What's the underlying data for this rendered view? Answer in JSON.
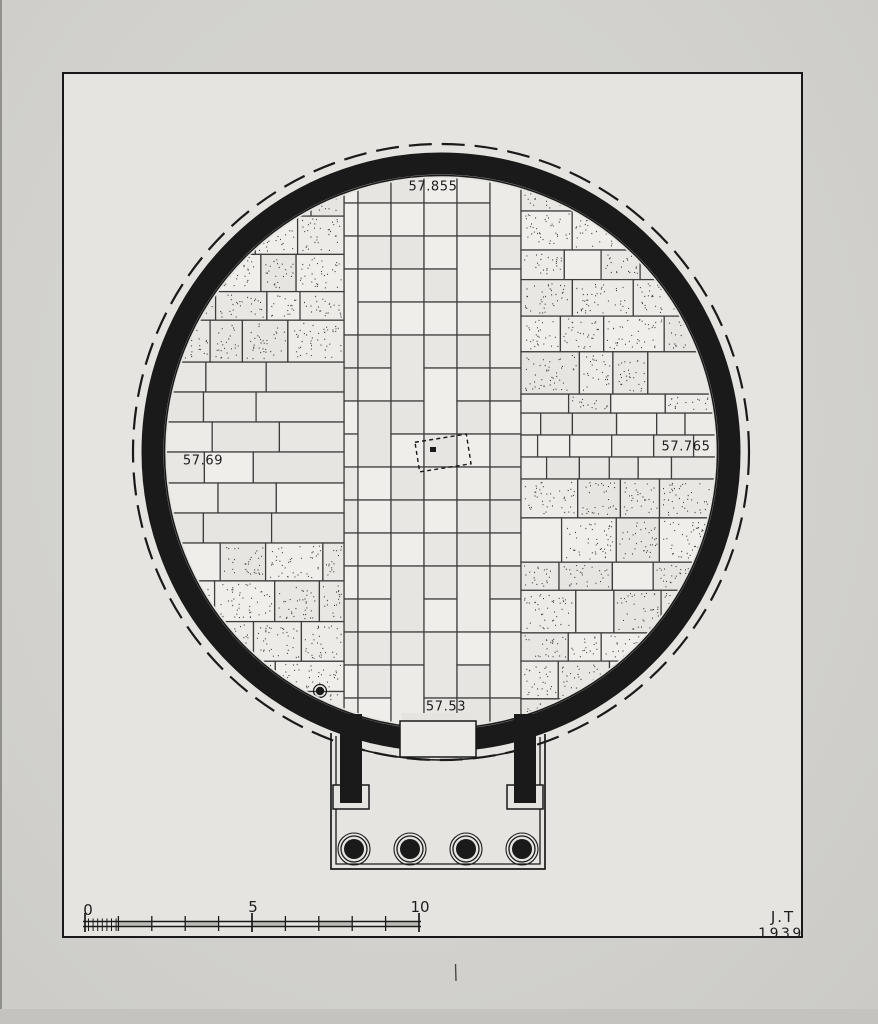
{
  "drawing": {
    "elevation_labels": {
      "top": "57.855",
      "left": "57.69",
      "right": "57.765",
      "bottom": "57.53"
    },
    "scale_bar": {
      "zero": "0",
      "five": "5",
      "ten": "10"
    },
    "signature": {
      "initials": "J.T",
      "year": "1939"
    },
    "colors": {
      "ink": "#1a1a1a",
      "paper": "#e5e4e0",
      "photo_bg": "#d2d1cd",
      "slab": "#eae8e4",
      "joint": "#3d3d3d",
      "stipple": "#2b2b2b"
    }
  }
}
